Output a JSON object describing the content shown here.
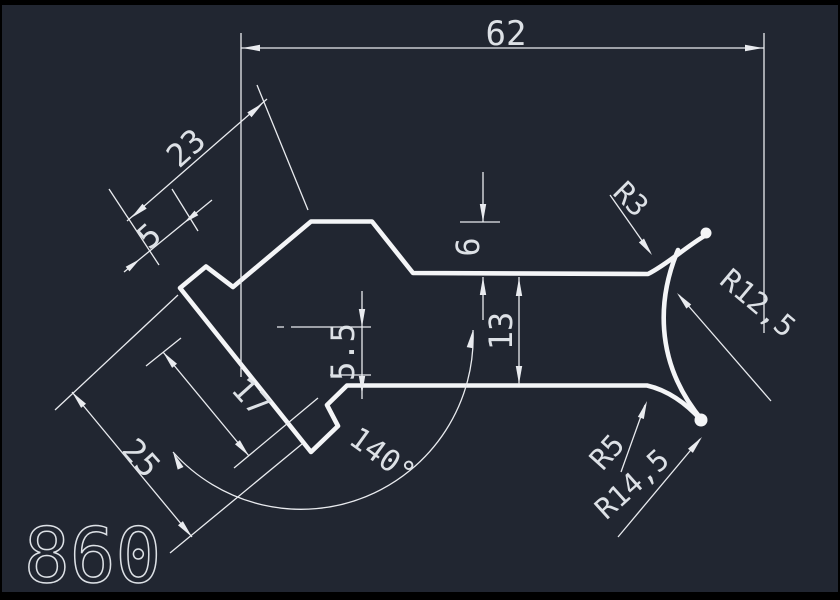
{
  "title_block": {
    "part_number": "860"
  },
  "colors": {
    "background": "#212631",
    "frame": "#000000",
    "line": "#e9ebef",
    "profile": "#f4f5f7",
    "text": "#dde1e6"
  },
  "dimensions": {
    "overall_width": {
      "label": "62"
    },
    "upper_leg": {
      "label": "23"
    },
    "step_width": {
      "label": "5"
    },
    "top_offset": {
      "label": "6"
    },
    "channel_height": {
      "label": "13"
    },
    "step_height": {
      "label": "5.5"
    },
    "lower_leg": {
      "label": "17"
    },
    "leg_length": {
      "label": "25"
    },
    "bend_angle": {
      "label": "140°"
    }
  },
  "radii": {
    "r3": {
      "label": "R3"
    },
    "r12_5": {
      "label": "R12,5"
    },
    "r5": {
      "label": "R5"
    },
    "r14_5": {
      "label": "R14,5"
    }
  }
}
